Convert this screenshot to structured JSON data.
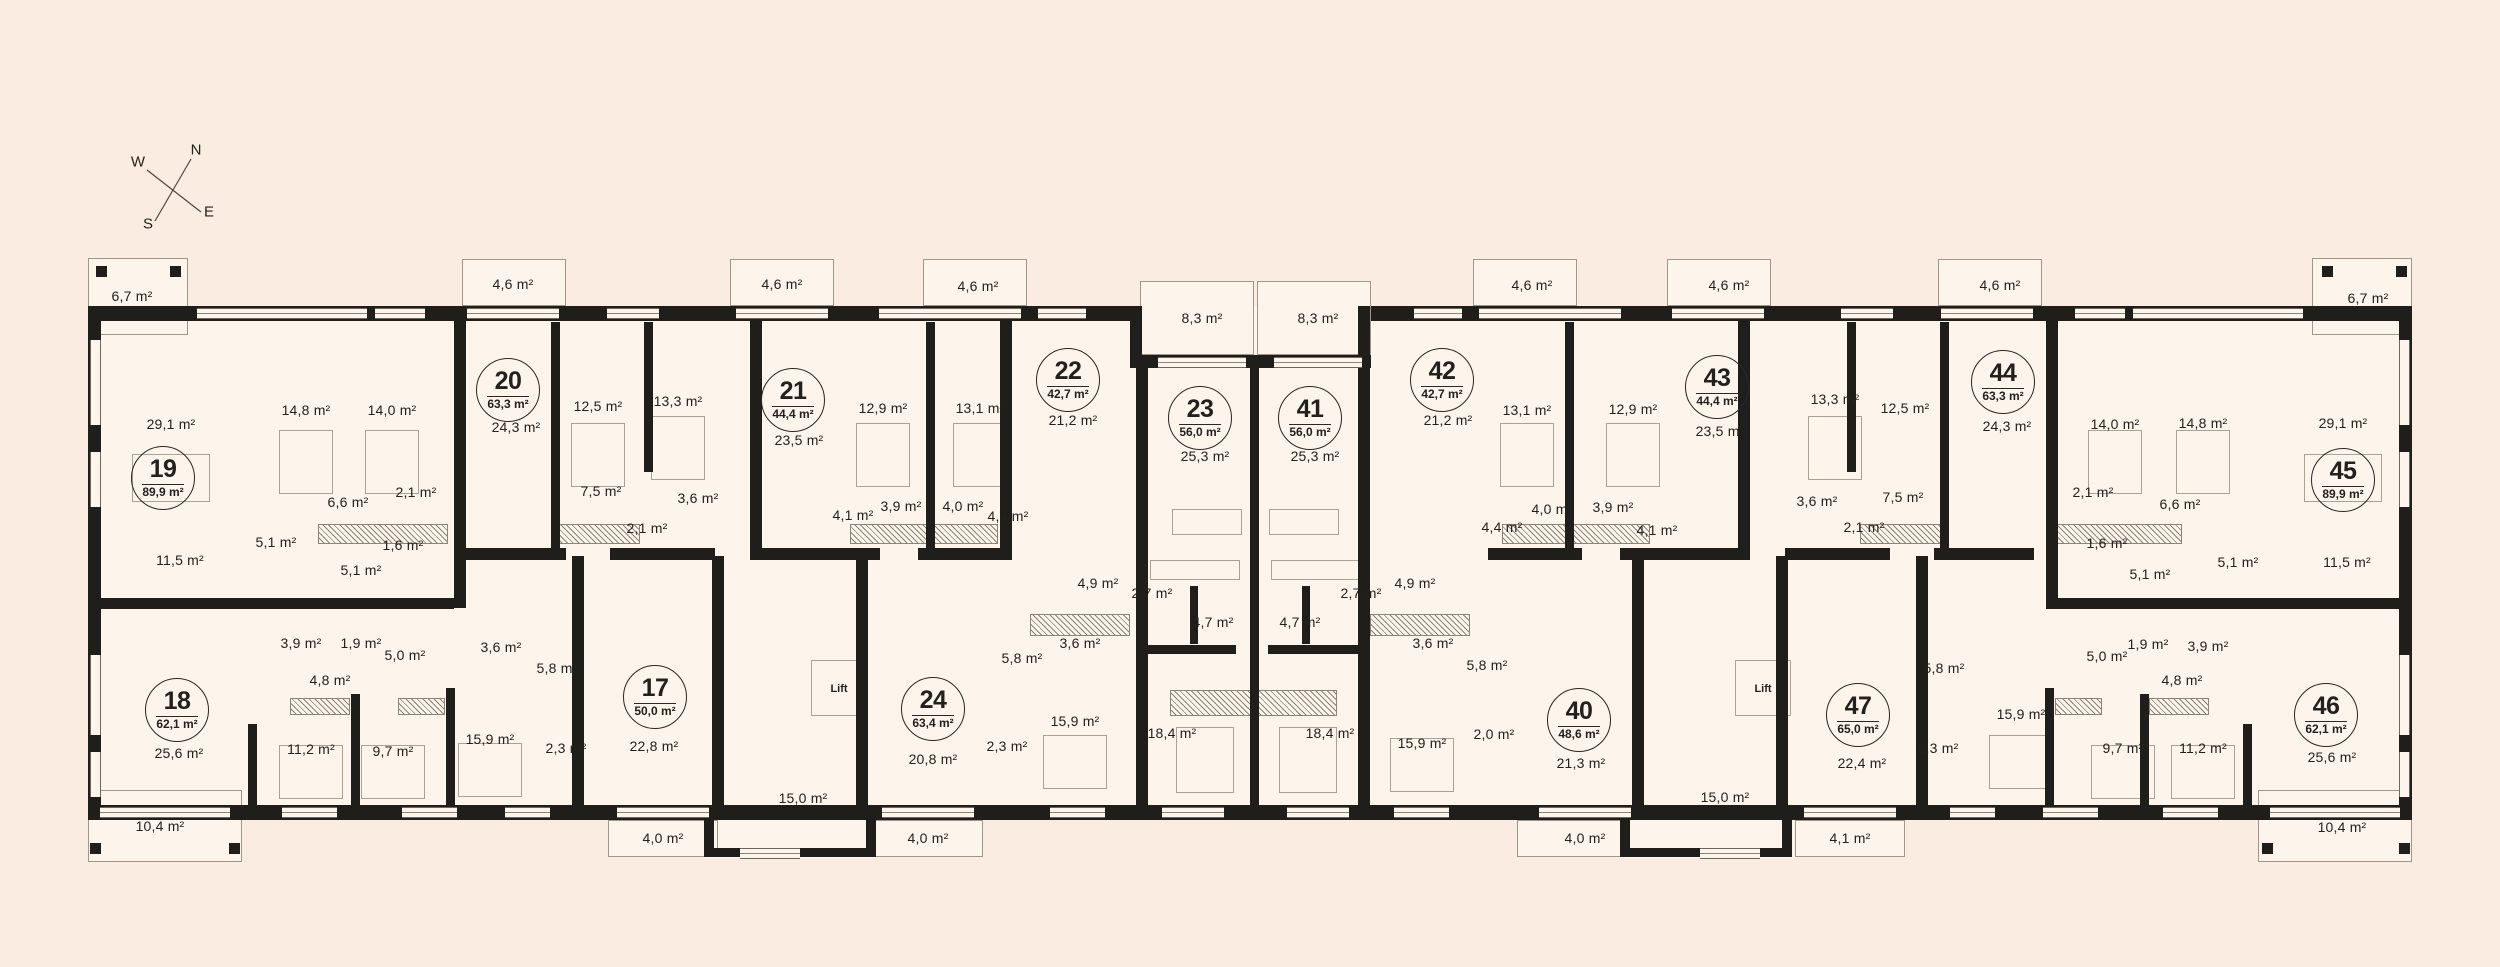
{
  "title": "Residential floor plan, apartments 17-24 and 40-47",
  "colors": {
    "background": "#fbece1",
    "floor": "#fdf4ec",
    "wall": "#201e1b",
    "text": "#23211e"
  },
  "compass": {
    "n": "N",
    "w": "W",
    "s": "S",
    "e": "E"
  },
  "apartments": [
    {
      "number": "19",
      "area": "89,9 m²",
      "x": 163,
      "y": 478
    },
    {
      "number": "18",
      "area": "62,1 m²",
      "x": 177,
      "y": 710
    },
    {
      "number": "20",
      "area": "63,3 m²",
      "x": 508,
      "y": 390
    },
    {
      "number": "21",
      "area": "44,4 m²",
      "x": 793,
      "y": 400
    },
    {
      "number": "22",
      "area": "42,7 m²",
      "x": 1068,
      "y": 380
    },
    {
      "number": "23",
      "area": "56,0 m²",
      "x": 1200,
      "y": 418
    },
    {
      "number": "41",
      "area": "56,0 m²",
      "x": 1310,
      "y": 418
    },
    {
      "number": "42",
      "area": "42,7 m²",
      "x": 1442,
      "y": 380
    },
    {
      "number": "43",
      "area": "44,4 m²",
      "x": 1717,
      "y": 387
    },
    {
      "number": "44",
      "area": "63,3 m²",
      "x": 2003,
      "y": 382
    },
    {
      "number": "45",
      "area": "89,9 m²",
      "x": 2343,
      "y": 480
    },
    {
      "number": "17",
      "area": "50,0 m²",
      "x": 655,
      "y": 697
    },
    {
      "number": "24",
      "area": "63,4 m²",
      "x": 933,
      "y": 709
    },
    {
      "number": "40",
      "area": "48,6 m²",
      "x": 1579,
      "y": 720
    },
    {
      "number": "47",
      "area": "65,0 m²",
      "x": 1858,
      "y": 715
    },
    {
      "number": "46",
      "area": "62,1 m²",
      "x": 2326,
      "y": 715
    }
  ],
  "rooms": [
    {
      "label": "6,7 m²",
      "x": 132,
      "y": 296
    },
    {
      "label": "4,6 m²",
      "x": 513,
      "y": 284
    },
    {
      "label": "4,6 m²",
      "x": 782,
      "y": 284
    },
    {
      "label": "4,6 m²",
      "x": 978,
      "y": 286
    },
    {
      "label": "8,3 m²",
      "x": 1202,
      "y": 318
    },
    {
      "label": "8,3 m²",
      "x": 1318,
      "y": 318
    },
    {
      "label": "29,1 m²",
      "x": 171,
      "y": 424
    },
    {
      "label": "14,8 m²",
      "x": 306,
      "y": 410
    },
    {
      "label": "14,0 m²",
      "x": 392,
      "y": 410
    },
    {
      "label": "24,3 m²",
      "x": 516,
      "y": 427
    },
    {
      "label": "12,5 m²",
      "x": 598,
      "y": 406
    },
    {
      "label": "13,3 m²",
      "x": 678,
      "y": 401
    },
    {
      "label": "23,5 m²",
      "x": 799,
      "y": 440
    },
    {
      "label": "12,9 m²",
      "x": 883,
      "y": 408
    },
    {
      "label": "13,1 m²",
      "x": 980,
      "y": 408
    },
    {
      "label": "21,2 m²",
      "x": 1073,
      "y": 420
    },
    {
      "label": "25,3 m²",
      "x": 1205,
      "y": 456
    },
    {
      "label": "25,3 m²",
      "x": 1315,
      "y": 456
    },
    {
      "label": "6,6 m²",
      "x": 348,
      "y": 502
    },
    {
      "label": "2,1 m²",
      "x": 416,
      "y": 492
    },
    {
      "label": "1,6 m²",
      "x": 403,
      "y": 545
    },
    {
      "label": "11,5 m²",
      "x": 180,
      "y": 560
    },
    {
      "label": "5,1 m²",
      "x": 276,
      "y": 542
    },
    {
      "label": "5,1 m²",
      "x": 361,
      "y": 570
    },
    {
      "label": "7,5 m²",
      "x": 601,
      "y": 491
    },
    {
      "label": "3,6 m²",
      "x": 698,
      "y": 498
    },
    {
      "label": "2,1 m²",
      "x": 647,
      "y": 528
    },
    {
      "label": "4,1 m²",
      "x": 853,
      "y": 515
    },
    {
      "label": "3,9 m²",
      "x": 901,
      "y": 506
    },
    {
      "label": "4,0 m²",
      "x": 963,
      "y": 506
    },
    {
      "label": "4,4 m²",
      "x": 1008,
      "y": 516
    },
    {
      "label": "4,9 m²",
      "x": 1098,
      "y": 583
    },
    {
      "label": "2,7 m²",
      "x": 1152,
      "y": 593
    },
    {
      "label": "4,7 m²",
      "x": 1213,
      "y": 622
    },
    {
      "label": "3,9 m²",
      "x": 301,
      "y": 643
    },
    {
      "label": "1,9 m²",
      "x": 361,
      "y": 643
    },
    {
      "label": "5,0 m²",
      "x": 405,
      "y": 655
    },
    {
      "label": "4,8 m²",
      "x": 330,
      "y": 680
    },
    {
      "label": "3,6 m²",
      "x": 501,
      "y": 647
    },
    {
      "label": "5,8 m²",
      "x": 557,
      "y": 668
    },
    {
      "label": "25,6 m²",
      "x": 179,
      "y": 753
    },
    {
      "label": "11,2 m²",
      "x": 311,
      "y": 749
    },
    {
      "label": "9,7 m²",
      "x": 393,
      "y": 751
    },
    {
      "label": "15,9 m²",
      "x": 490,
      "y": 739
    },
    {
      "label": "2,3 m²",
      "x": 566,
      "y": 748
    },
    {
      "label": "22,8 m²",
      "x": 654,
      "y": 746
    },
    {
      "label": "15,0 m²",
      "x": 803,
      "y": 798
    },
    {
      "label": "4,0 m²",
      "x": 663,
      "y": 838
    },
    {
      "label": "4,0 m²",
      "x": 928,
      "y": 838
    },
    {
      "label": "10,4 m²",
      "x": 160,
      "y": 826
    },
    {
      "label": "20,8 m²",
      "x": 933,
      "y": 759
    },
    {
      "label": "2,3 m²",
      "x": 1007,
      "y": 746
    },
    {
      "label": "5,8 m²",
      "x": 1022,
      "y": 658
    },
    {
      "label": "3,6 m²",
      "x": 1080,
      "y": 643
    },
    {
      "label": "15,9 m²",
      "x": 1075,
      "y": 721
    },
    {
      "label": "18,4 m²",
      "x": 1172,
      "y": 733
    },
    {
      "label": "18,4 m²",
      "x": 1330,
      "y": 733
    },
    {
      "label": "4,7 m²",
      "x": 1300,
      "y": 622
    },
    {
      "label": "2,7 m²",
      "x": 1361,
      "y": 593
    },
    {
      "label": "4,9 m²",
      "x": 1415,
      "y": 583
    },
    {
      "label": "3,6 m²",
      "x": 1433,
      "y": 643
    },
    {
      "label": "15,9 m²",
      "x": 1422,
      "y": 743
    },
    {
      "label": "2,0 m²",
      "x": 1494,
      "y": 734
    },
    {
      "label": "5,8 m²",
      "x": 1487,
      "y": 665
    },
    {
      "label": "21,2 m²",
      "x": 1448,
      "y": 420
    },
    {
      "label": "13,1 m²",
      "x": 1527,
      "y": 410
    },
    {
      "label": "12,9 m²",
      "x": 1633,
      "y": 409
    },
    {
      "label": "23,5 m²",
      "x": 1720,
      "y": 431
    },
    {
      "label": "13,3 m²",
      "x": 1835,
      "y": 399
    },
    {
      "label": "12,5 m²",
      "x": 1905,
      "y": 408
    },
    {
      "label": "24,3 m²",
      "x": 2007,
      "y": 426
    },
    {
      "label": "14,0 m²",
      "x": 2115,
      "y": 424
    },
    {
      "label": "14,8 m²",
      "x": 2203,
      "y": 423
    },
    {
      "label": "29,1 m²",
      "x": 2343,
      "y": 423
    },
    {
      "label": "4,0 m²",
      "x": 1552,
      "y": 509
    },
    {
      "label": "3,9 m²",
      "x": 1613,
      "y": 507
    },
    {
      "label": "4,4 m²",
      "x": 1502,
      "y": 527
    },
    {
      "label": "4,1 m²",
      "x": 1657,
      "y": 530
    },
    {
      "label": "3,6 m²",
      "x": 1817,
      "y": 501
    },
    {
      "label": "7,5 m²",
      "x": 1903,
      "y": 497
    },
    {
      "label": "2,1 m²",
      "x": 1864,
      "y": 527
    },
    {
      "label": "2,1 m²",
      "x": 2093,
      "y": 492
    },
    {
      "label": "6,6 m²",
      "x": 2180,
      "y": 504
    },
    {
      "label": "1,6 m²",
      "x": 2107,
      "y": 543
    },
    {
      "label": "5,1 m²",
      "x": 2150,
      "y": 574
    },
    {
      "label": "5,1 m²",
      "x": 2238,
      "y": 562
    },
    {
      "label": "11,5 m²",
      "x": 2347,
      "y": 562
    },
    {
      "label": "21,3 m²",
      "x": 1581,
      "y": 763
    },
    {
      "label": "15,0 m²",
      "x": 1725,
      "y": 797
    },
    {
      "label": "22,4 m²",
      "x": 1862,
      "y": 763
    },
    {
      "label": "2,3 m²",
      "x": 1938,
      "y": 748
    },
    {
      "label": "5,8 m²",
      "x": 1944,
      "y": 668
    },
    {
      "label": "5,0 m²",
      "x": 2107,
      "y": 656
    },
    {
      "label": "1,9 m²",
      "x": 2148,
      "y": 644
    },
    {
      "label": "3,9 m²",
      "x": 2208,
      "y": 646
    },
    {
      "label": "4,8 m²",
      "x": 2182,
      "y": 680
    },
    {
      "label": "15,9 m²",
      "x": 2021,
      "y": 714
    },
    {
      "label": "9,7 m²",
      "x": 2123,
      "y": 748
    },
    {
      "label": "11,2 m²",
      "x": 2203,
      "y": 748
    },
    {
      "label": "25,6 m²",
      "x": 2332,
      "y": 757
    },
    {
      "label": "4,0 m²",
      "x": 1585,
      "y": 838
    },
    {
      "label": "4,1 m²",
      "x": 1850,
      "y": 838
    },
    {
      "label": "10,4 m²",
      "x": 2342,
      "y": 827
    },
    {
      "label": "6,7 m²",
      "x": 2368,
      "y": 298
    },
    {
      "label": "4,6 m²",
      "x": 1532,
      "y": 285
    },
    {
      "label": "4,6 m²",
      "x": 1729,
      "y": 285
    },
    {
      "label": "4,6 m²",
      "x": 2000,
      "y": 285
    }
  ],
  "lifts": [
    {
      "label": "Lift",
      "x": 839,
      "y": 689
    },
    {
      "label": "Lift",
      "x": 1763,
      "y": 689
    }
  ]
}
